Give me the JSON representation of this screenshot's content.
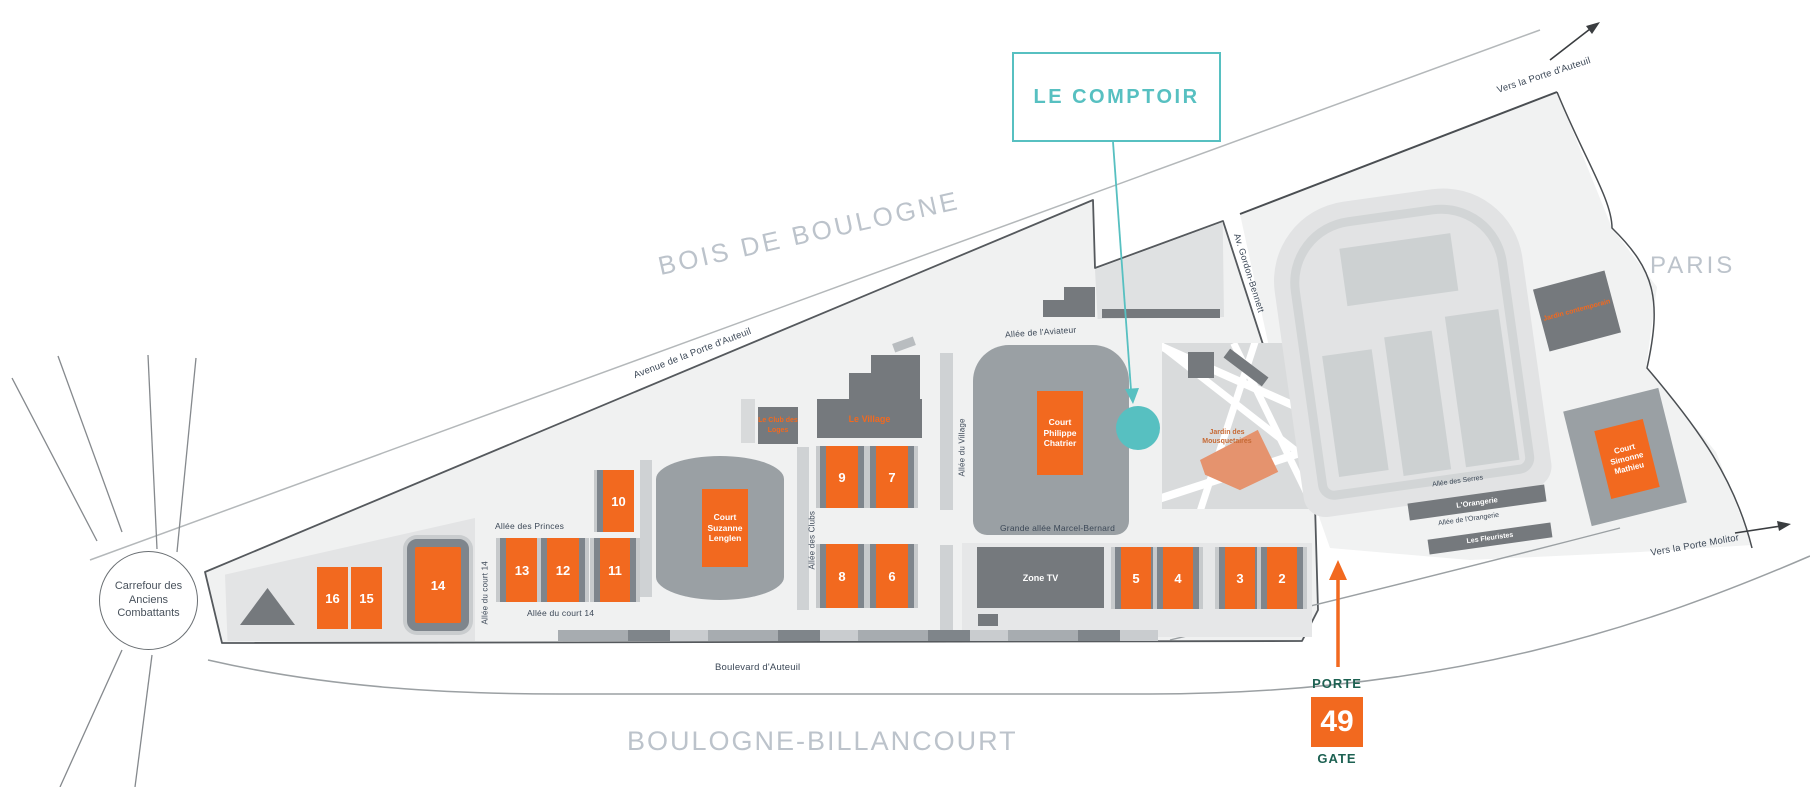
{
  "colors": {
    "accent-teal": "#57c0c1",
    "court-orange": "#f2691f",
    "building-gray": "#75797d",
    "stadium-gray": "#9aa0a4",
    "gate-green": "#1d6152",
    "salmon": "#e5936e",
    "area-label": "#bcc3cb",
    "road-label": "#3c4857"
  },
  "callout": {
    "label": "LE COMPTOIR"
  },
  "gate": {
    "porte": "PORTE",
    "number": "49",
    "gate": "GATE"
  },
  "areas": {
    "bois_de_boulogne": "BOIS DE BOULOGNE",
    "paris": "PARIS",
    "boulogne_billancourt": "BOULOGNE-BILLANCOURT",
    "carrefour": "Carrefour des Anciens Combattants"
  },
  "roads": {
    "avenue_porte_auteuil": "Avenue de la Porte d'Auteuil",
    "boulevard_auteuil": "Boulevard d'Auteuil",
    "av_gordon_bennett": "Av. Gordon-Bennett",
    "vers_porte_auteuil": "Vers la Porte d'Auteuil",
    "vers_porte_molitor": "Vers la Porte Molitor",
    "allee_aviateur": "Allée de l'Aviateur",
    "allee_princes": "Allée des Princes",
    "allee_court14_vertical": "Allée du court 14",
    "allee_court14_horizontal": "Allée du court 14",
    "allee_clubs": "Allée des Clubs",
    "allee_village": "Allée du Village",
    "grande_allee": "Grande allée Marcel-Bernard",
    "allee_serres": "Allée des Serres",
    "allee_orangerie": "Allée de l'Orangerie"
  },
  "venues": {
    "chatrier": "Court Philippe Chatrier",
    "lenglen": "Court Suzanne Lenglen",
    "mathieu": "Court Simonne Mathieu",
    "village": "Le Village",
    "club_des_loges": "Le Club des Loges",
    "zone_tv": "Zone TV",
    "orangerie": "L'Orangerie",
    "fleuristes": "Les Fleuristes",
    "jardin_contemporain": "Jardin contemporain",
    "jardin_mousquetaires": "Jardin des Mousquetaires"
  },
  "courts": [
    "16",
    "15",
    "14",
    "13",
    "12",
    "11",
    "10",
    "9",
    "8",
    "7",
    "6",
    "5",
    "4",
    "3",
    "2"
  ]
}
